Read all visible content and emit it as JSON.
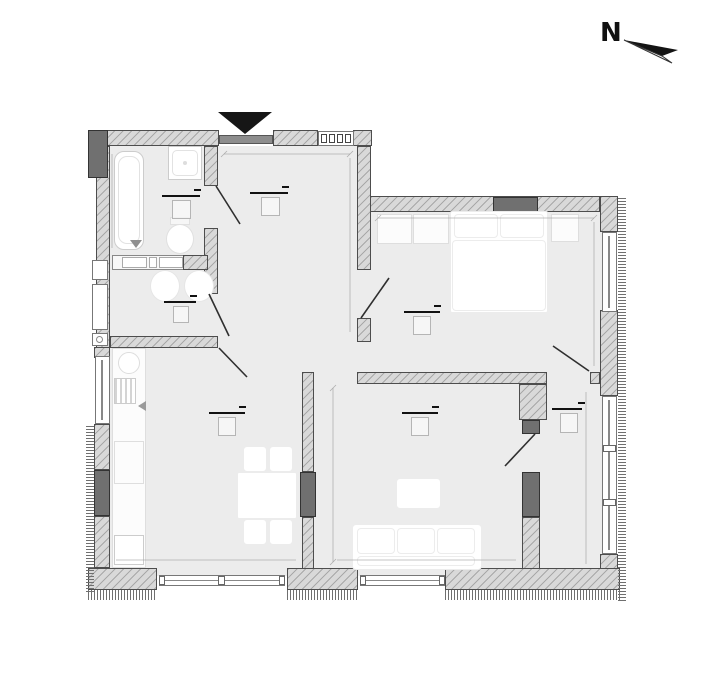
{
  "compass": {
    "north_label": "N"
  },
  "colors": {
    "floor": "#ececec",
    "wall_hatch_bg": "#d9d9d9",
    "wall_hatch_line": "#a8a8a8",
    "wall_border": "#4d4d4d",
    "pier": "#707070",
    "pier_border": "#333333",
    "comb": "#6f6f6f",
    "door_line": "#2f2f2f",
    "dim_line": "#9a9a9a",
    "label_line": "#111111",
    "label_box_border": "#b5b5b5",
    "furniture_border": "#dedede",
    "fixture_border": "#cccccc",
    "entrance_marker": "#161616",
    "threshold": "#8d8d8d"
  }
}
